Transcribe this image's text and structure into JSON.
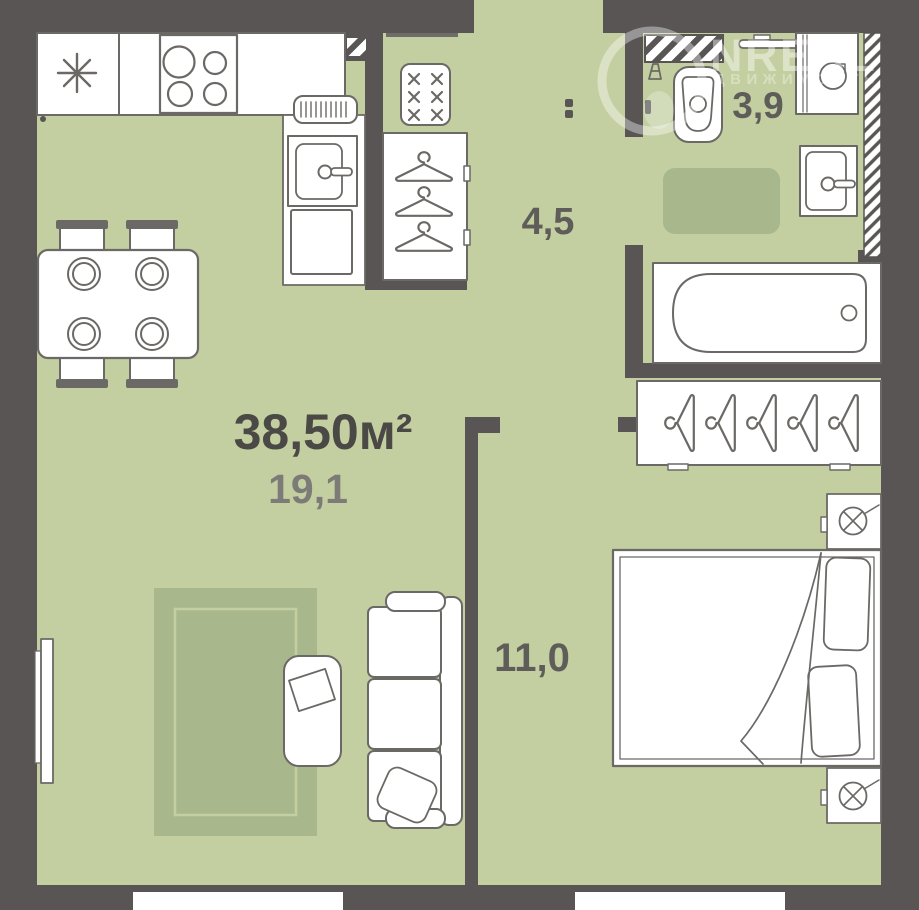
{
  "labels": {
    "total_area": "38,50м²",
    "living_area": "19,1",
    "hallway_area": "4,5",
    "bathroom_area": "3,9",
    "bedroom_area": "11,0"
  },
  "watermark": {
    "brand": "NREAL",
    "subtitle": "ДВИЖИМОСТЬ"
  },
  "colors": {
    "wall": "#585554",
    "floor": "#c3cfa0",
    "rug": "#a9b88c",
    "outline": "#6b6966",
    "label_dark": "#4b4946",
    "label_mid": "#5f5d59",
    "label_light": "#7d7b77"
  }
}
